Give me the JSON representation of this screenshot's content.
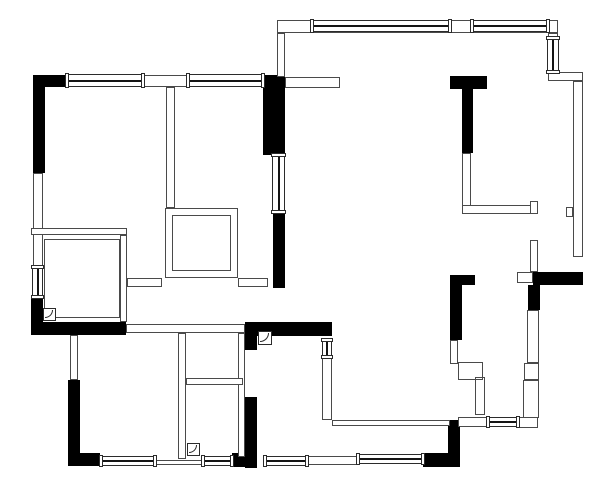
{
  "canvas": {
    "width": 600,
    "height": 483,
    "background": "#ffffff"
  },
  "colors": {
    "structural_wall": "#000000",
    "partition_outline": "#4a4a4a",
    "partition_fill": "#ffffff",
    "window_line": "#141414"
  },
  "plan": {
    "black_walls": [
      [
        33,
        75,
        34,
        12
      ],
      [
        33,
        75,
        12,
        98
      ],
      [
        31,
        297,
        12,
        38
      ],
      [
        31,
        322,
        95,
        13
      ],
      [
        263,
        75,
        22,
        80
      ],
      [
        273,
        212,
        12,
        76
      ],
      [
        450,
        76,
        37,
        13
      ],
      [
        462,
        89,
        11,
        64
      ],
      [
        533,
        272,
        50,
        13
      ],
      [
        528,
        285,
        12,
        25
      ],
      [
        450,
        275,
        12,
        65
      ],
      [
        462,
        275,
        13,
        10
      ],
      [
        245,
        322,
        87,
        14
      ],
      [
        245,
        322,
        12,
        28
      ],
      [
        245,
        397,
        12,
        71
      ],
      [
        232,
        453,
        23,
        14
      ],
      [
        68,
        380,
        12,
        85
      ],
      [
        68,
        453,
        32,
        13
      ],
      [
        423,
        453,
        37,
        14
      ],
      [
        448,
        420,
        12,
        47
      ]
    ],
    "thin_walls": [
      [
        143,
        75,
        45,
        12
      ],
      [
        33,
        173,
        10,
        95
      ],
      [
        31,
        228,
        96,
        7
      ],
      [
        120,
        235,
        7,
        87
      ],
      [
        166,
        87,
        9,
        121
      ],
      [
        277,
        20,
        281,
        13
      ],
      [
        277,
        33,
        8,
        44
      ],
      [
        285,
        77,
        55,
        11
      ],
      [
        548,
        33,
        10,
        6
      ],
      [
        548,
        72,
        35,
        9
      ],
      [
        573,
        81,
        10,
        176
      ],
      [
        566,
        207,
        7,
        10
      ],
      [
        517,
        272,
        16,
        11
      ],
      [
        530,
        240,
        8,
        32
      ],
      [
        527,
        310,
        12,
        53
      ],
      [
        524,
        363,
        15,
        17
      ],
      [
        523,
        380,
        16,
        38
      ],
      [
        518,
        417,
        20,
        11
      ],
      [
        458,
        417,
        30,
        10
      ],
      [
        462,
        153,
        9,
        54
      ],
      [
        462,
        205,
        76,
        9
      ],
      [
        530,
        201,
        8,
        13
      ],
      [
        450,
        340,
        8,
        24
      ],
      [
        322,
        357,
        10,
        63
      ],
      [
        332,
        420,
        118,
        6
      ],
      [
        126,
        324,
        119,
        9
      ],
      [
        70,
        335,
        8,
        45
      ],
      [
        178,
        333,
        8,
        126
      ],
      [
        238,
        333,
        7,
        124
      ],
      [
        186,
        378,
        57,
        7
      ],
      [
        155,
        460,
        47,
        5
      ],
      [
        308,
        456,
        50,
        9
      ],
      [
        127,
        278,
        35,
        9
      ],
      [
        238,
        278,
        30,
        9
      ]
    ],
    "inner_outlines": [
      [
        44,
        239,
        76,
        79
      ],
      [
        165,
        208,
        73,
        70
      ],
      [
        172,
        215,
        59,
        56
      ],
      [
        458,
        362,
        25,
        18
      ],
      [
        475,
        377,
        10,
        38
      ]
    ],
    "windows_horizontal": [
      [
        66,
        74,
        78,
        13
      ],
      [
        187,
        74,
        77,
        13
      ],
      [
        311,
        20,
        140,
        12
      ],
      [
        471,
        20,
        78,
        12
      ],
      [
        100,
        456,
        56,
        10
      ],
      [
        202,
        456,
        31,
        10
      ],
      [
        264,
        456,
        44,
        10
      ],
      [
        357,
        454,
        67,
        10
      ],
      [
        487,
        417,
        32,
        10
      ]
    ],
    "windows_vertical": [
      [
        32,
        266,
        11,
        32
      ],
      [
        272,
        154,
        13,
        59
      ],
      [
        547,
        37,
        12,
        36
      ],
      [
        322,
        339,
        10,
        19
      ]
    ],
    "doors": [
      [
        43,
        308,
        13
      ],
      [
        187,
        443,
        13
      ],
      [
        258,
        331,
        14
      ]
    ]
  }
}
